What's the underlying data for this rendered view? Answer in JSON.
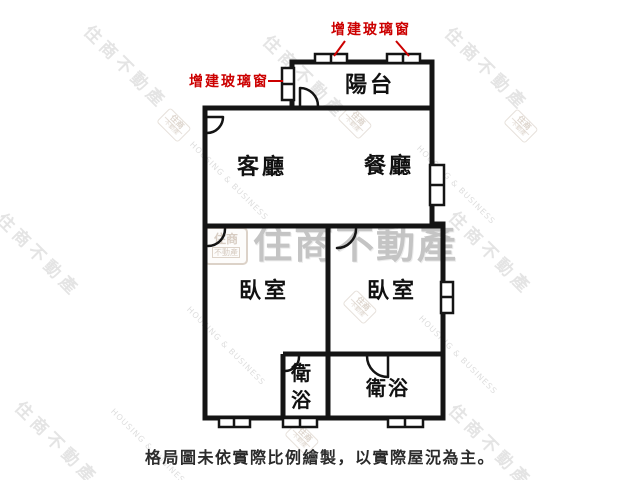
{
  "watermark": {
    "brand": "住商不動產",
    "brand_en": "HOUSING & BUSINESS",
    "logo_line1": "住商",
    "logo_line2": "不動產"
  },
  "annotations": {
    "added_glass_window_top": "增建玻璃窗",
    "added_glass_window_left": "增建玻璃窗"
  },
  "rooms": {
    "balcony": "陽台",
    "living": "客廳",
    "dining": "餐廳",
    "bedroom_left": "臥室",
    "bedroom_right": "臥室",
    "bath_left": "衛浴",
    "bath_right": "衛浴"
  },
  "caption": "格局圖未依實際比例繪製，以實際屋況為主。",
  "colors": {
    "annotation_red": "#cc0000",
    "wall_black": "#141414",
    "watermark_gray": "#c4c4c4"
  }
}
